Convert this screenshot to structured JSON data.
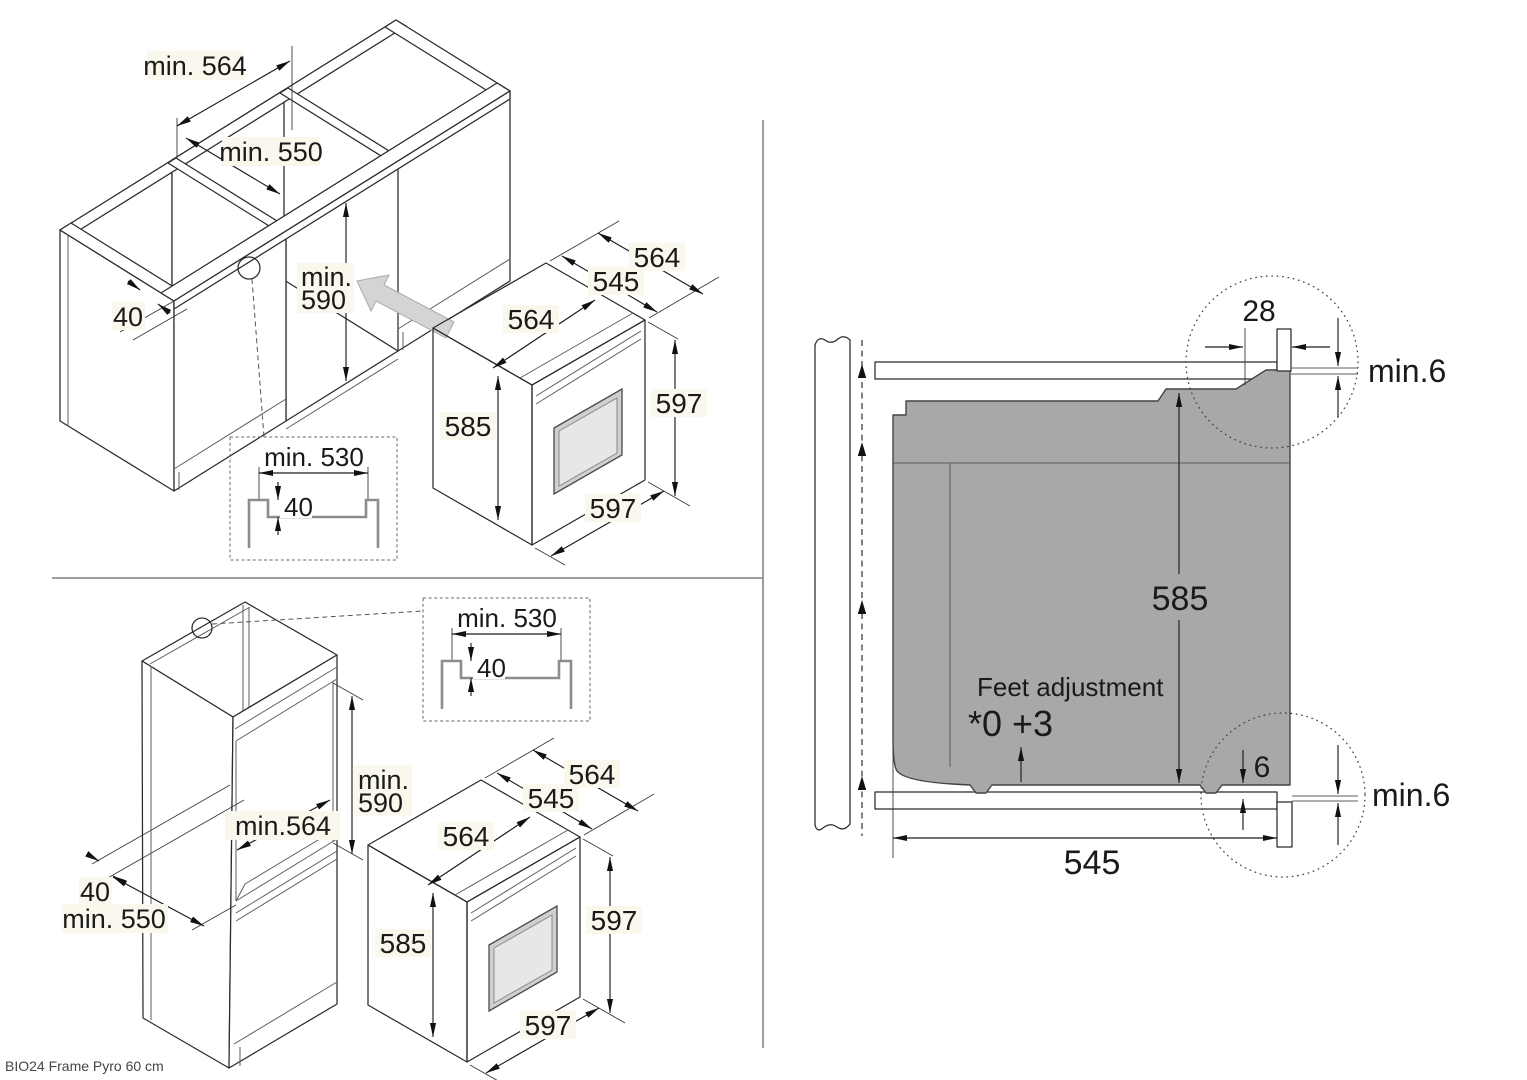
{
  "footer": {
    "label": "BIO24 Frame Pyro 60 cm"
  },
  "colors": {
    "line": "#2b2b2b",
    "oven_top": "#a8a8a8",
    "oven_side": "#9c9c9c",
    "oven_front": "#b4b4b4",
    "section_body": "#a8a8a8",
    "insert_arrow": "#d4d4d4",
    "label_highlight": "#faf8ec"
  },
  "oven": {
    "body_width": "564",
    "body_depth": "545",
    "total_depth": "564",
    "body_height": "585",
    "front_height": "597",
    "front_width": "597"
  },
  "groove": {
    "width": "min. 530",
    "depth": "40"
  },
  "base_unit_view": {
    "niche_width": "min. 564",
    "niche_depth": "min. 550",
    "min_label": "min.",
    "niche_height": "590",
    "front_rail": "40"
  },
  "tall_unit_view": {
    "min_label": "min.",
    "niche_height": "590",
    "niche_width": "min.564",
    "front_rail": "40",
    "niche_depth": "min. 550"
  },
  "section_view": {
    "top_recess": "28",
    "top_clearance": "min.6",
    "body_height": "585",
    "feet_label": "Feet adjustment",
    "feet_values": "*0 +3",
    "bottom_offset": "6",
    "bottom_clearance": "min.6",
    "body_depth": "545"
  }
}
